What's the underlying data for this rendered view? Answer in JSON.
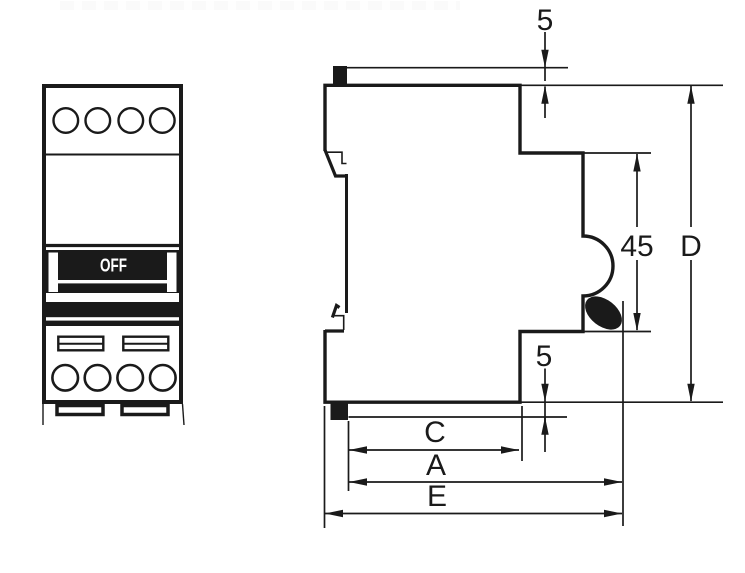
{
  "colors": {
    "ink": "#1a1a1a",
    "paper": "#ffffff"
  },
  "front_view": {
    "toggle_label": "OFF"
  },
  "side_view_dimensions": {
    "top_clearance": "5",
    "front_section_height": "45",
    "overall_height": "D",
    "bottom_clearance": "5",
    "depth_c": "C",
    "depth_a": "A",
    "depth_e": "E"
  }
}
